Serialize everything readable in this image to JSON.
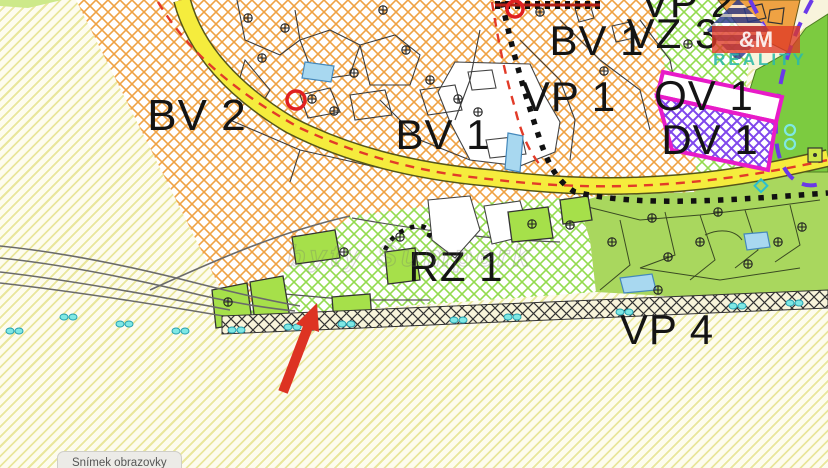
{
  "map": {
    "zone_labels": [
      {
        "code": "BV 2"
      },
      {
        "code": "BV 1"
      },
      {
        "code": "BV 1"
      },
      {
        "code": "VP 2"
      },
      {
        "code": "VZ 3"
      },
      {
        "code": "VP 1"
      },
      {
        "code": "OV 1"
      },
      {
        "code": "DV 1"
      },
      {
        "code": "RZ 1"
      },
      {
        "code": "VP 4"
      }
    ],
    "watermark": {
      "site_text": "byty Šumperk",
      "logo_amp": "&M",
      "logo_reality": "REALITY"
    },
    "colors": {
      "orange_hatch": "#efa243",
      "green_hatch": "#93db4e",
      "purple_hatch": "#7f46ec",
      "magenta_border": "#e81bc8",
      "road_yellow": "#f5ec3d",
      "solid_green": "#a9d75e",
      "bright_green_parcel": "#a6e04a",
      "dark_strip": "#333333",
      "cyan_marker": "#7fe8e4",
      "purple_dash": "#6a39e8",
      "red_dash": "#e23b28",
      "arrow_red": "#dd3322",
      "pale_stripe": "#e9e69c"
    }
  },
  "annotation": {
    "arrow": "points to parcel above VP 4 strip"
  },
  "ui": {
    "screenshot_button_label": "Snímek obrazovky"
  }
}
